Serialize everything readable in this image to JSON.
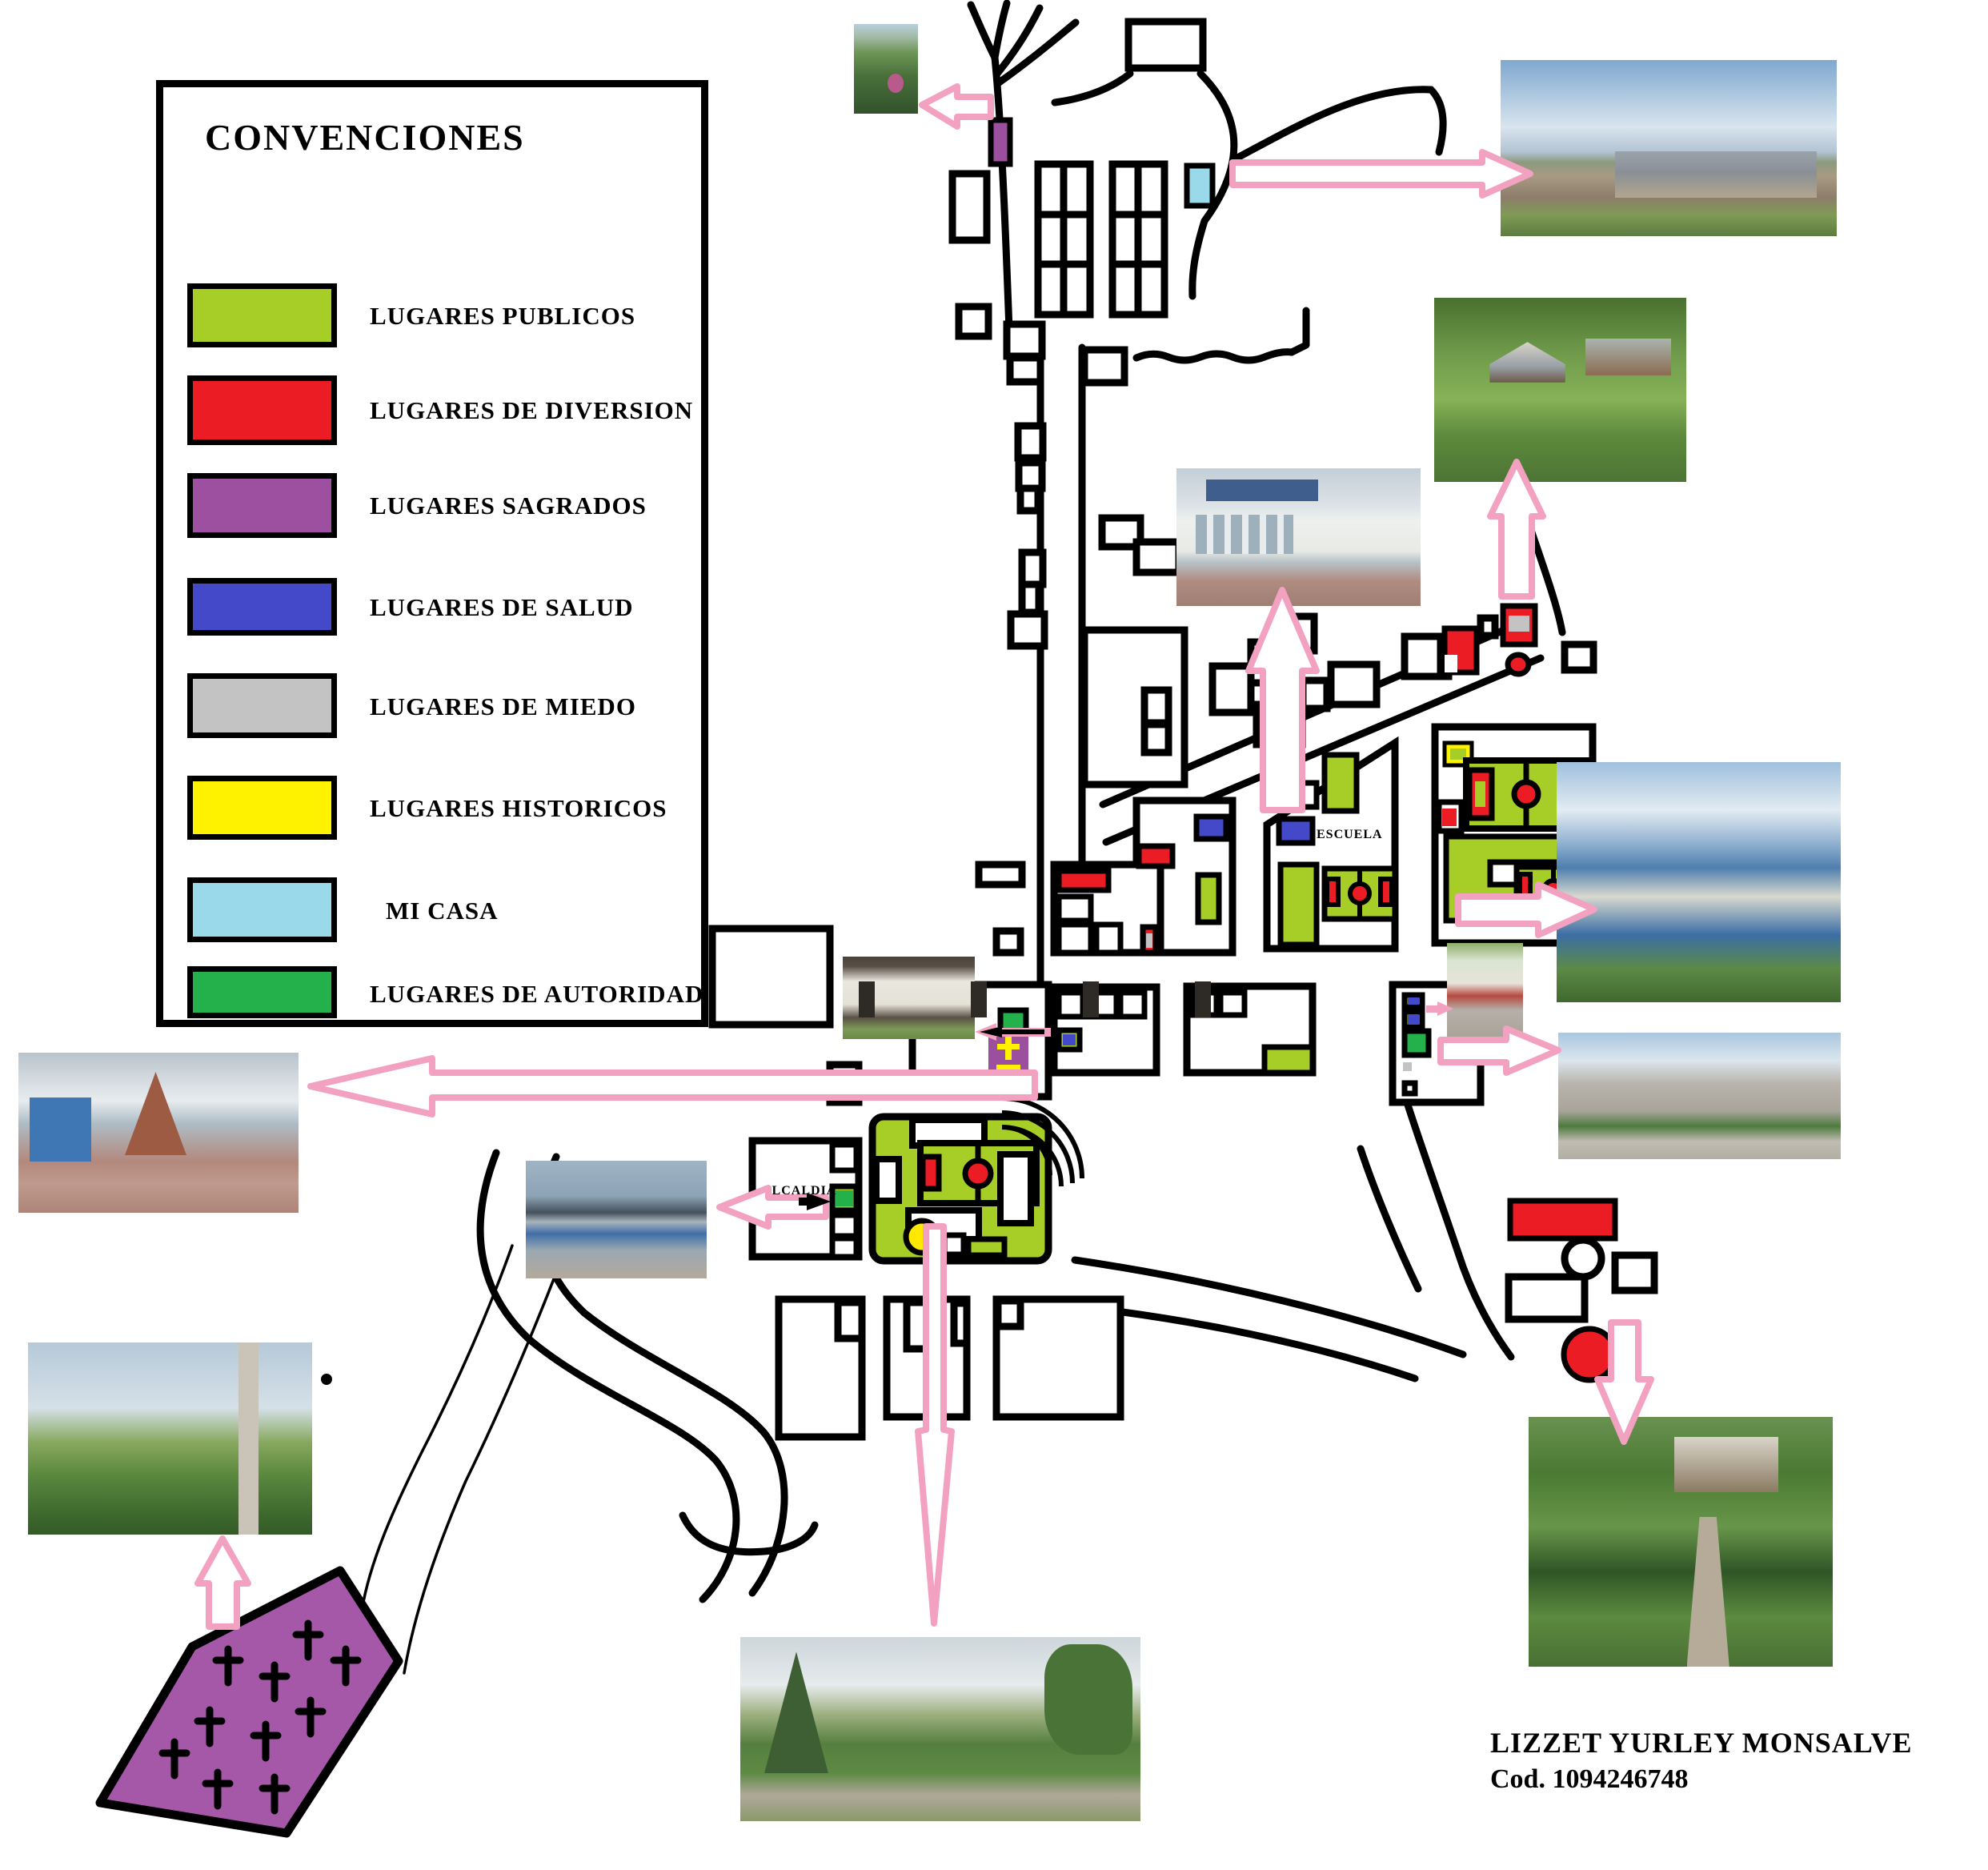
{
  "legend": {
    "title": "CONVENCIONES",
    "items": [
      {
        "name": "lugares-publicos",
        "label": "LUGARES PUBLICOS",
        "color": "#A6CE27"
      },
      {
        "name": "lugares-de-diversion",
        "label": "LUGARES DE DIVERSION",
        "color": "#EC1C24"
      },
      {
        "name": "lugares-sagrados",
        "label": "LUGARES SAGRADOS",
        "color": "#9C509F"
      },
      {
        "name": "lugares-de-salud",
        "label": "LUGARES DE SALUD",
        "color": "#4349C8"
      },
      {
        "name": "lugares-de-miedo",
        "label": "LUGARES DE MIEDO",
        "color": "#C3C3C3"
      },
      {
        "name": "lugares-historicos",
        "label": "LUGARES HISTORICOS",
        "color": "#FFF200"
      },
      {
        "name": "mi-casa",
        "label": "MI CASA",
        "color": "#99D9EA"
      },
      {
        "name": "lugares-de-autoridad",
        "label": "LUGARES DE AUTORIDAD",
        "color": "#24B14C"
      }
    ]
  },
  "map_labels": {
    "escuela": "ESCUELA",
    "colegio": "COLEGIO",
    "alcaldia": "ALCALDIA"
  },
  "signature": {
    "line1": "LIZZET YURLEY MONSALVE",
    "line2": "Cod. 1094246748"
  },
  "map_colors": {
    "road_black": "#000000",
    "arrow_pink": "#F2A2C0",
    "field_green": "#A6CE27",
    "authority_green": "#24B14C",
    "church_purple": "#9C4F9F",
    "cemetery_purple": "#A557A8",
    "cross_tower_yellow": "#FFF200",
    "fountain_yellow": "#FFE900",
    "salud_blue": "#4349C8",
    "mi_casa_cyan": "#99D9EA",
    "diversion_red": "#EC1C24",
    "miedo_gray": "#C3C3C3"
  },
  "photos": [
    {
      "name": "photo-garden-shrine",
      "depicts": "garden with shrine and pink flowers"
    },
    {
      "name": "photo-rural-houses",
      "depicts": "row of rural houses along dirt road (mi casa)"
    },
    {
      "name": "photo-farm",
      "depicts": "farm with kiosk hut and fences"
    },
    {
      "name": "photo-escuela",
      "depicts": "white school building with brick stairs"
    },
    {
      "name": "photo-colegio",
      "depicts": "school with blue roof and blue fence"
    },
    {
      "name": "photo-corner-house",
      "depicts": "green and white corner house with steps"
    },
    {
      "name": "photo-palacio-municipal",
      "depicts": "gray municipal building with flags"
    },
    {
      "name": "photo-old-white-house",
      "depicts": "old white house with dark doors and motorcycle"
    },
    {
      "name": "photo-church",
      "depicts": "A-frame brick church with wide stairs"
    },
    {
      "name": "photo-alcaldia",
      "depicts": "blue two-story palacio municipal building"
    },
    {
      "name": "photo-hill",
      "depicts": "green hill with utility pole"
    },
    {
      "name": "photo-park",
      "depicts": "tree-lined park with hedges and path"
    },
    {
      "name": "photo-vegetation",
      "depicts": "dense vegetation with dirt path and rural house"
    }
  ]
}
